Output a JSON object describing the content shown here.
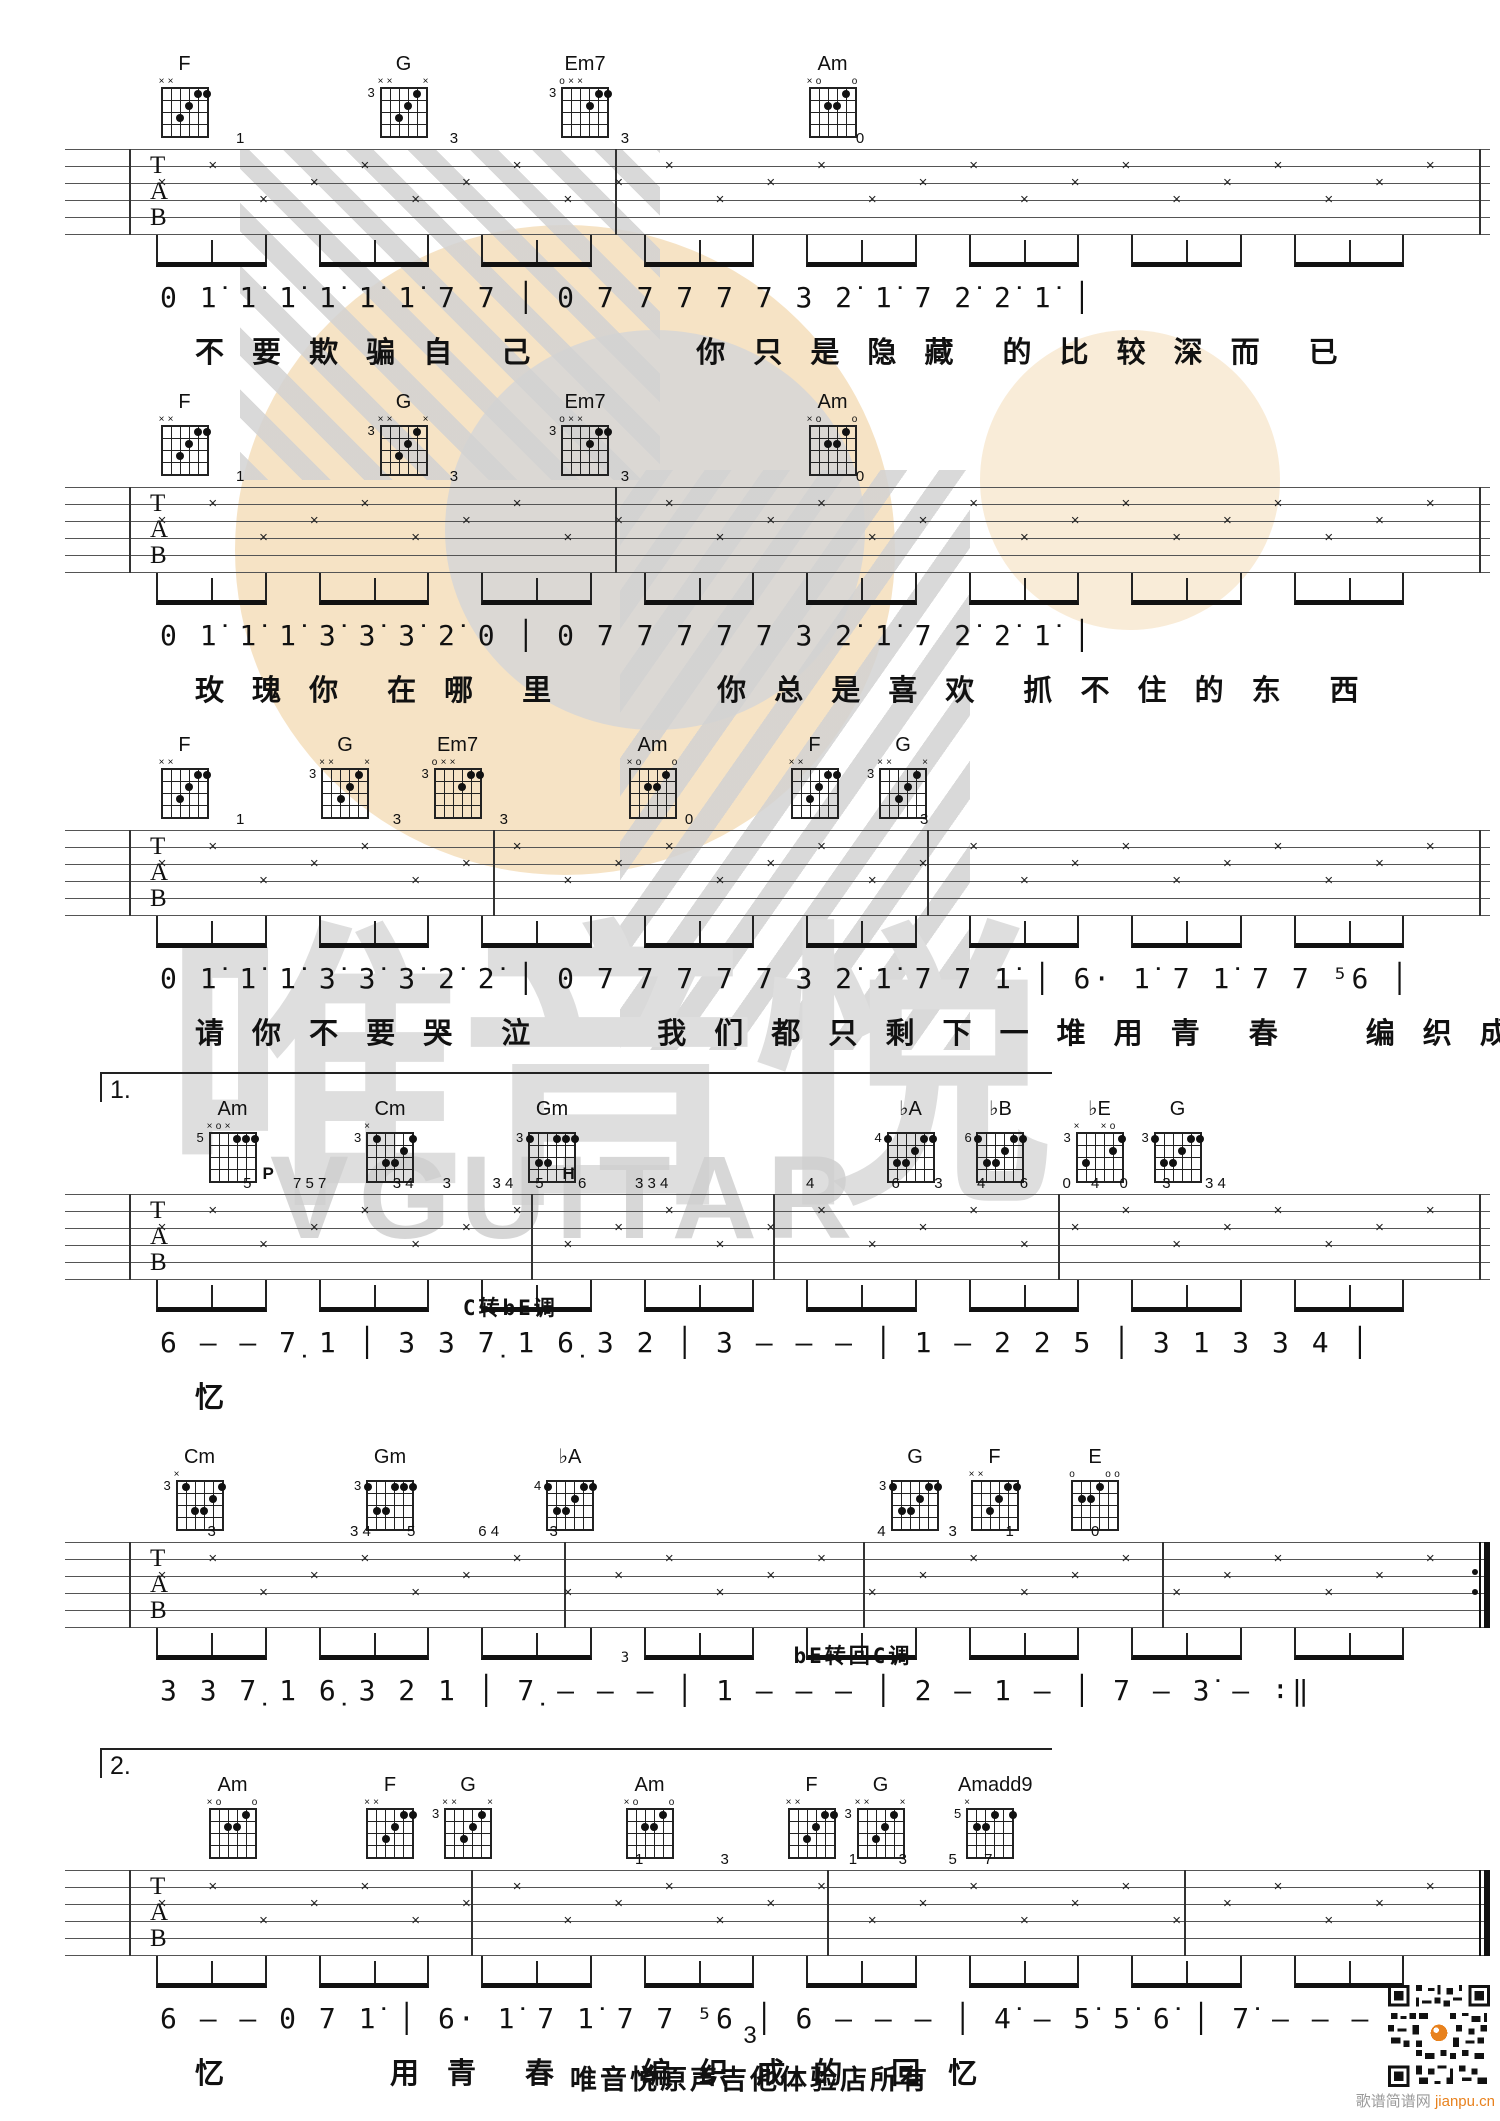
{
  "watermark": {
    "cn": "唯音悦",
    "en": "VGUITAR"
  },
  "footer": {
    "page_number": "3",
    "text": "唯音悦原声吉他体验店所有",
    "qr_site": "歌谱简谱网",
    "qr_domain": "jianpu.cn"
  },
  "colors": {
    "peach": "#f6e3c5",
    "gray_circle": "#d6d6d6",
    "stripe": "#d2d2d2",
    "watermark_text": "#dedede",
    "accent_orange": "#e8821e"
  },
  "staff_clef": [
    "T",
    "A",
    "B"
  ],
  "systems": [
    {
      "ending": null,
      "end": "single",
      "chords": [
        {
          "name": "F",
          "fret": "",
          "markers": "xx----",
          "x": 12.3,
          "dots": [
            [
              3,
              3
            ],
            [
              4,
              2
            ],
            [
              5,
              1
            ],
            [
              6,
              1
            ]
          ]
        },
        {
          "name": "G",
          "fret": "3",
          "markers": "xx---x",
          "x": 26.9,
          "dots": [
            [
              3,
              3
            ],
            [
              4,
              2
            ],
            [
              5,
              1
            ]
          ]
        },
        {
          "name": "Em7",
          "fret": "3",
          "markers": "oxx---",
          "x": 39.0,
          "dots": [
            [
              4,
              2
            ],
            [
              5,
              1
            ],
            [
              6,
              1
            ]
          ]
        },
        {
          "name": "Am",
          "fret": "",
          "markers": "xo---o",
          "x": 55.5,
          "dots": [
            [
              3,
              2
            ],
            [
              4,
              2
            ],
            [
              5,
              1
            ]
          ]
        }
      ],
      "marks": [
        {
          "t": "1",
          "x": 12
        },
        {
          "t": "3",
          "x": 27
        },
        {
          "t": "3",
          "x": 39
        },
        {
          "t": "0",
          "x": 55.5
        }
      ],
      "labels": [],
      "barlines": [
        4.5,
        38.6,
        99.2
      ],
      "jianpu": "0 1̇ 1̇ 1̇ 1̇ 1̇ 1̇ 7 7 │ 0 7 7 7 7 7 3 2̇ 1̇ 7 2̇ 2̇ 1̇ │",
      "lyrics": "不 要 欺 骗 自　己　　　　你 只 是 隐 藏　的 比 较 深 而　已"
    },
    {
      "ending": null,
      "end": "single",
      "chords": [
        {
          "name": "F",
          "fret": "",
          "markers": "xx----",
          "x": 12.3,
          "dots": [
            [
              3,
              3
            ],
            [
              4,
              2
            ],
            [
              5,
              1
            ],
            [
              6,
              1
            ]
          ]
        },
        {
          "name": "G",
          "fret": "3",
          "markers": "xx---x",
          "x": 26.9,
          "dots": [
            [
              3,
              3
            ],
            [
              4,
              2
            ],
            [
              5,
              1
            ]
          ]
        },
        {
          "name": "Em7",
          "fret": "3",
          "markers": "oxx---",
          "x": 39.0,
          "dots": [
            [
              4,
              2
            ],
            [
              5,
              1
            ],
            [
              6,
              1
            ]
          ]
        },
        {
          "name": "Am",
          "fret": "",
          "markers": "xo---o",
          "x": 55.5,
          "dots": [
            [
              3,
              2
            ],
            [
              4,
              2
            ],
            [
              5,
              1
            ]
          ]
        }
      ],
      "marks": [
        {
          "t": "1",
          "x": 12
        },
        {
          "t": "3",
          "x": 27
        },
        {
          "t": "3",
          "x": 39
        },
        {
          "t": "0",
          "x": 55.5
        }
      ],
      "labels": [],
      "barlines": [
        4.5,
        38.6,
        99.2
      ],
      "jianpu": "0 1̇ 1̇ 1̇ 3̇ 3̇ 3̇ 2̇ 0 │ 0 7 7 7 7 7 3 2̇ 1̇ 7 2̇ 2̇ 1̇ │",
      "lyrics": "玫 瑰 你　在 哪　里　　　　你 总 是 喜 欢　抓 不 住 的 东　西"
    },
    {
      "ending": null,
      "end": "single",
      "chords": [
        {
          "name": "F",
          "fret": "",
          "markers": "xx----",
          "x": 12.3,
          "dots": [
            [
              3,
              3
            ],
            [
              4,
              2
            ],
            [
              5,
              1
            ],
            [
              6,
              1
            ]
          ]
        },
        {
          "name": "G",
          "fret": "3",
          "markers": "xx---x",
          "x": 23.0,
          "dots": [
            [
              3,
              3
            ],
            [
              4,
              2
            ],
            [
              5,
              1
            ]
          ]
        },
        {
          "name": "Em7",
          "fret": "3",
          "markers": "oxx---",
          "x": 30.5,
          "dots": [
            [
              4,
              2
            ],
            [
              5,
              1
            ],
            [
              6,
              1
            ]
          ]
        },
        {
          "name": "Am",
          "fret": "",
          "markers": "xo---o",
          "x": 43.5,
          "dots": [
            [
              3,
              2
            ],
            [
              4,
              2
            ],
            [
              5,
              1
            ]
          ]
        },
        {
          "name": "F",
          "fret": "",
          "markers": "xx----",
          "x": 54.3,
          "dots": [
            [
              3,
              3
            ],
            [
              4,
              2
            ],
            [
              5,
              1
            ],
            [
              6,
              1
            ]
          ]
        },
        {
          "name": "G",
          "fret": "3",
          "markers": "xx---x",
          "x": 60.2,
          "dots": [
            [
              3,
              3
            ],
            [
              4,
              2
            ],
            [
              5,
              1
            ]
          ]
        }
      ],
      "marks": [
        {
          "t": "1",
          "x": 12
        },
        {
          "t": "3",
          "x": 23
        },
        {
          "t": "3",
          "x": 30.5
        },
        {
          "t": "0",
          "x": 43.5
        },
        {
          "t": "3",
          "x": 60
        }
      ],
      "labels": [],
      "barlines": [
        4.5,
        30.0,
        60.5,
        99.2
      ],
      "jianpu": "0 1̇ 1̇ 1̇ 3̇ 3̇ 3̇ 2̇ 2̇ │ 0 7 7 7 7 7 3 2̇ 1̇ 7 7 1̇ │ 6· 1̇ 7 1̇ 7 7 ⁵6 │",
      "lyrics": "请 你 不 要 哭　泣　　　我 们 都 只 剩 下 一 堆 用 青　春　　编 织 成 的　回"
    },
    {
      "ending": "1.",
      "end": "single",
      "chords": [
        {
          "name": "Am",
          "fret": "5",
          "markers": "xox---",
          "x": 15.5,
          "dots": [
            [
              4,
              1
            ],
            [
              5,
              1
            ],
            [
              6,
              1
            ]
          ]
        },
        {
          "name": "Cm",
          "fret": "3",
          "markers": "x-----",
          "x": 26.0,
          "dots": [
            [
              2,
              1
            ],
            [
              6,
              1
            ],
            [
              5,
              2
            ],
            [
              3,
              3
            ],
            [
              4,
              3
            ]
          ]
        },
        {
          "name": "Gm",
          "fret": "3",
          "markers": "------",
          "x": 36.8,
          "dots": [
            [
              1,
              1
            ],
            [
              4,
              1
            ],
            [
              5,
              1
            ],
            [
              6,
              1
            ],
            [
              2,
              3
            ],
            [
              3,
              3
            ]
          ]
        },
        {
          "name": "♭A",
          "fret": "4",
          "markers": "------",
          "x": 60.7,
          "dots": [
            [
              1,
              1
            ],
            [
              5,
              1
            ],
            [
              6,
              1
            ],
            [
              4,
              2
            ],
            [
              2,
              3
            ],
            [
              3,
              3
            ]
          ]
        },
        {
          "name": "♭B",
          "fret": "6",
          "markers": "------",
          "x": 66.7,
          "dots": [
            [
              1,
              1
            ],
            [
              5,
              1
            ],
            [
              6,
              1
            ],
            [
              4,
              2
            ],
            [
              2,
              3
            ],
            [
              3,
              3
            ]
          ]
        },
        {
          "name": "♭E",
          "fret": "3",
          "markers": "x--xo-",
          "x": 73.3,
          "dots": [
            [
              6,
              1
            ],
            [
              5,
              2
            ],
            [
              2,
              3
            ]
          ]
        },
        {
          "name": "G",
          "fret": "3",
          "markers": "------",
          "x": 78.5,
          "dots": [
            [
              1,
              1
            ],
            [
              5,
              1
            ],
            [
              6,
              1
            ],
            [
              4,
              2
            ],
            [
              2,
              3
            ],
            [
              3,
              3
            ]
          ]
        }
      ],
      "marks": [
        {
          "t": "5",
          "x": 12.5
        },
        {
          "t": "7 5 7",
          "x": 16
        },
        {
          "t": "3 4",
          "x": 23
        },
        {
          "t": "3",
          "x": 26.5
        },
        {
          "t": "3 4",
          "x": 30
        },
        {
          "t": "5",
          "x": 33
        },
        {
          "t": "6",
          "x": 36
        },
        {
          "t": "3 3 4",
          "x": 40
        },
        {
          "t": "4",
          "x": 52
        },
        {
          "t": "6",
          "x": 58
        },
        {
          "t": "3",
          "x": 61
        },
        {
          "t": "4",
          "x": 64
        },
        {
          "t": "6",
          "x": 67
        },
        {
          "t": "0",
          "x": 70
        },
        {
          "t": "4",
          "x": 72
        },
        {
          "t": "0",
          "x": 74
        },
        {
          "t": "3",
          "x": 77
        },
        {
          "t": "3 4",
          "x": 80
        }
      ],
      "labels": [
        {
          "text": "P",
          "x": 17.5,
          "where": "chords"
        },
        {
          "text": "H",
          "x": 37.5,
          "where": "chords"
        },
        {
          "text": "C转bE调",
          "x": 25,
          "where": "jianpu"
        }
      ],
      "barlines": [
        4.5,
        32.7,
        49.7,
        69.7,
        99.2
      ],
      "jianpu": "6 — — 7̣ 1 │ 3 3 7̣ 1 6̣ 3 2 │ 3 — — — │ 1 — 2 2 5 │ 3 1 3 3 4 │",
      "lyrics": "忆"
    },
    {
      "ending": null,
      "end": "repeat",
      "chords": [
        {
          "name": "Cm",
          "fret": "3",
          "markers": "x-----",
          "x": 13.3,
          "dots": [
            [
              2,
              1
            ],
            [
              6,
              1
            ],
            [
              5,
              2
            ],
            [
              3,
              3
            ],
            [
              4,
              3
            ]
          ]
        },
        {
          "name": "Gm",
          "fret": "3",
          "markers": "------",
          "x": 26.0,
          "dots": [
            [
              1,
              1
            ],
            [
              4,
              1
            ],
            [
              5,
              1
            ],
            [
              6,
              1
            ],
            [
              2,
              3
            ],
            [
              3,
              3
            ]
          ]
        },
        {
          "name": "♭A",
          "fret": "4",
          "markers": "------",
          "x": 38.0,
          "dots": [
            [
              1,
              1
            ],
            [
              5,
              1
            ],
            [
              6,
              1
            ],
            [
              4,
              2
            ],
            [
              2,
              3
            ],
            [
              3,
              3
            ]
          ]
        },
        {
          "name": "G",
          "fret": "3",
          "markers": "------",
          "x": 61.0,
          "dots": [
            [
              1,
              1
            ],
            [
              5,
              1
            ],
            [
              6,
              1
            ],
            [
              4,
              2
            ],
            [
              2,
              3
            ],
            [
              3,
              3
            ]
          ]
        },
        {
          "name": "F",
          "fret": "",
          "markers": "xx----",
          "x": 66.3,
          "dots": [
            [
              3,
              3
            ],
            [
              4,
              2
            ],
            [
              5,
              1
            ],
            [
              6,
              1
            ]
          ]
        },
        {
          "name": "E",
          "fret": "",
          "markers": "o---oo",
          "x": 73.0,
          "dots": [
            [
              4,
              1
            ],
            [
              2,
              2
            ],
            [
              3,
              2
            ]
          ]
        }
      ],
      "marks": [
        {
          "t": "3",
          "x": 10
        },
        {
          "t": "3 4",
          "x": 20
        },
        {
          "t": "5",
          "x": 24
        },
        {
          "t": "6 4",
          "x": 29
        },
        {
          "t": "3",
          "x": 34
        },
        {
          "t": "4",
          "x": 57
        },
        {
          "t": "3",
          "x": 62
        },
        {
          "t": "1",
          "x": 66
        },
        {
          "t": "0",
          "x": 72
        }
      ],
      "labels": [
        {
          "text": "bE转回C调",
          "x": 55,
          "where": "jianpu"
        },
        {
          "text": "3",
          "x": 40,
          "where": "jianpu-small"
        }
      ],
      "barlines": [
        4.5,
        35.0,
        56.0,
        77.0,
        99.2
      ],
      "jianpu": "3 3 7̣ 1 6̣ 3 2 1 │ 7̣ — — — │ 1 — — — │ 2 — 1 — │ 7 — 3̇ — ∶‖",
      "lyrics": ""
    },
    {
      "ending": "2.",
      "end": "final",
      "chords": [
        {
          "name": "Am",
          "fret": "",
          "markers": "xo---o",
          "x": 15.5,
          "dots": [
            [
              3,
              2
            ],
            [
              4,
              2
            ],
            [
              5,
              1
            ]
          ]
        },
        {
          "name": "F",
          "fret": "",
          "markers": "xx----",
          "x": 26.0,
          "dots": [
            [
              3,
              3
            ],
            [
              4,
              2
            ],
            [
              5,
              1
            ],
            [
              6,
              1
            ]
          ]
        },
        {
          "name": "G",
          "fret": "3",
          "markers": "xx---x",
          "x": 31.2,
          "dots": [
            [
              3,
              3
            ],
            [
              4,
              2
            ],
            [
              5,
              1
            ]
          ]
        },
        {
          "name": "Am",
          "fret": "",
          "markers": "xo---o",
          "x": 43.3,
          "dots": [
            [
              3,
              2
            ],
            [
              4,
              2
            ],
            [
              5,
              1
            ]
          ]
        },
        {
          "name": "F",
          "fret": "",
          "markers": "xx----",
          "x": 54.1,
          "dots": [
            [
              3,
              3
            ],
            [
              4,
              2
            ],
            [
              5,
              1
            ],
            [
              6,
              1
            ]
          ]
        },
        {
          "name": "G",
          "fret": "3",
          "markers": "xx---x",
          "x": 58.7,
          "dots": [
            [
              3,
              3
            ],
            [
              4,
              2
            ],
            [
              5,
              1
            ]
          ]
        },
        {
          "name": "Amadd9",
          "fret": "5",
          "markers": "x-----",
          "x": 66.0,
          "dots": [
            [
              6,
              1
            ],
            [
              4,
              1
            ],
            [
              2,
              2
            ],
            [
              3,
              2
            ]
          ]
        }
      ],
      "marks": [
        {
          "t": "1",
          "x": 40
        },
        {
          "t": "3",
          "x": 46
        },
        {
          "t": "1",
          "x": 55
        },
        {
          "t": "3",
          "x": 58.5
        },
        {
          "t": "5",
          "x": 62
        },
        {
          "t": "7",
          "x": 64.5
        }
      ],
      "labels": [],
      "barlines": [
        4.5,
        28.5,
        53.5,
        78.5,
        99.2
      ],
      "jianpu": "6 — — 0 7 1̇ │ 6· 1̇ 7 1̇ 7 7 ⁵6 │ 6 — — — │ 4̇ — 5̇ 5̇ 6̇ │ 7̇ — — — ‖",
      "lyrics": "忆　　　　用 青　春　　编 织 成 的　回 忆"
    }
  ]
}
